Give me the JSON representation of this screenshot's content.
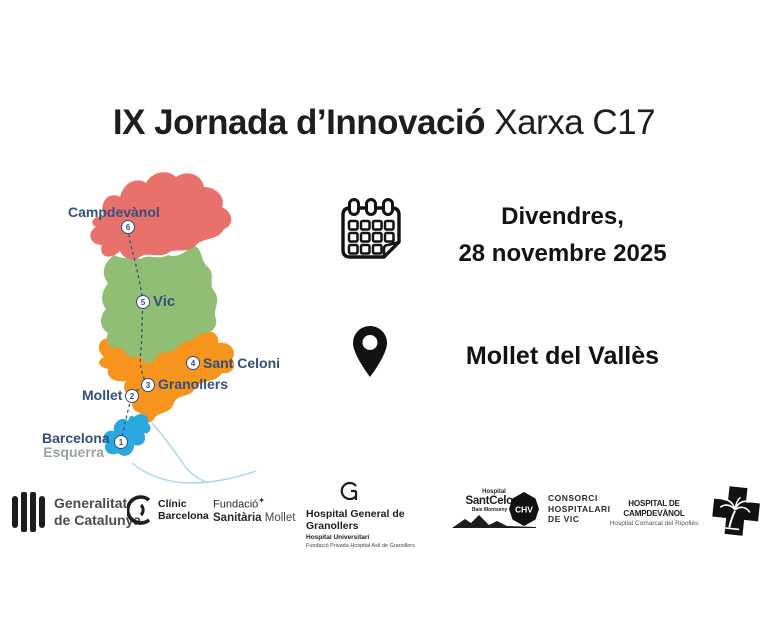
{
  "title": {
    "main": "IX Jornada d’Innovació",
    "suffix": " Xarxa C17"
  },
  "schedule": {
    "day": "Divendres,",
    "date": "28 novembre 2025"
  },
  "venue": {
    "name": "Mollet del Vallès"
  },
  "map": {
    "colors": {
      "ripolles": "#E8716B",
      "osona": "#90BE74",
      "valles": "#F6941E",
      "barcelona": "#2AA7DF",
      "route": "#33507D",
      "coast": "#A9D6EC"
    },
    "places": [
      {
        "num": "1",
        "label": "Barcelona",
        "label2": "Esquerra"
      },
      {
        "num": "2",
        "label": "Mollet"
      },
      {
        "num": "3",
        "label": "Granollers"
      },
      {
        "num": "4",
        "label": "Sant Celoni"
      },
      {
        "num": "5",
        "label": "Vic"
      },
      {
        "num": "6",
        "label": "Campdevànol"
      }
    ]
  },
  "logos": {
    "generalitat": {
      "line1": "Generalitat",
      "line2": "de Catalunya"
    },
    "clinic": {
      "line1": "Clínic",
      "line2": "Barcelona"
    },
    "fundacio": {
      "line1": "Fundació",
      "star": "✦",
      "line2_bold": "Sanitària",
      "line2_light": " Mollet"
    },
    "granollers": {
      "line1": "Hospital General de Granollers",
      "line2": "Hospital Universitari",
      "line3": "Fundació Privada Hospital Asil de Granollers"
    },
    "santceloni": {
      "line1": "Hospital",
      "line2a": "Sant",
      "line2b": "Celoni",
      "line3": "Baix Montseny"
    },
    "chv": {
      "badge": "CHV",
      "line1": "CONSORCI",
      "line2": "HOSPITALARI",
      "line3": "DE VIC"
    },
    "campdevanol": {
      "line1": "HOSPITAL DE CAMPDEVÀNOL",
      "line2": "Hospital Comarcal del Ripollès"
    }
  }
}
